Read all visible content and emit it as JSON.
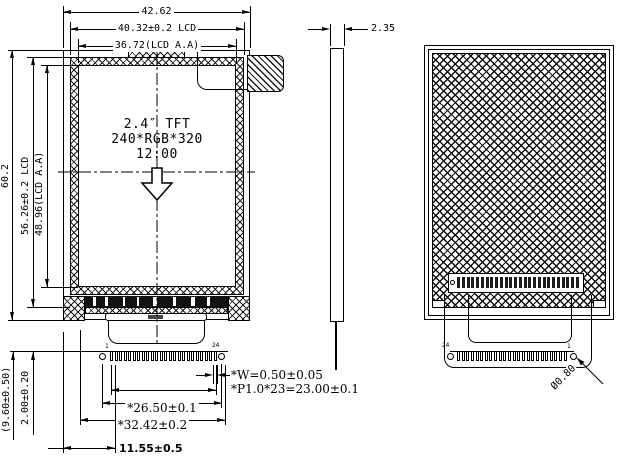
{
  "front_view": {
    "dims": {
      "overall_width": "42.62",
      "lcd_width": "40.32±0.2 LCD",
      "active_area_width": "36.72(LCD  A.A)",
      "overall_height": "60.2",
      "lcd_height": "56.26±0.2 LCD",
      "active_area_height": "48.96(LCD A.A)",
      "fpc_length": "(9.60±0.50)",
      "pin_exposed_length": "2.00±0.20",
      "pin_width": "*W=0.50±0.05",
      "pin_pitch": "*P1.0*23=23.00±0.1",
      "hole_span": "*26.50±0.1",
      "fpc_width": "*32.42±0.2",
      "fpc_offset": "11.55±0.5"
    },
    "labels": {
      "panel_size": "2.4″ TFT",
      "resolution": "240*RGB*320",
      "viewing_direction": "12:00",
      "pin_first": "1",
      "pin_last": "24"
    },
    "pin_count": 24
  },
  "side_view": {
    "dims": {
      "thickness": "2.35"
    }
  },
  "back_view": {
    "labels": {
      "pin_left": "24",
      "pin_right": "1"
    },
    "dims": {
      "hole_diameter": "Ø0.80"
    },
    "pin_count": 24,
    "contact_count": 26
  }
}
